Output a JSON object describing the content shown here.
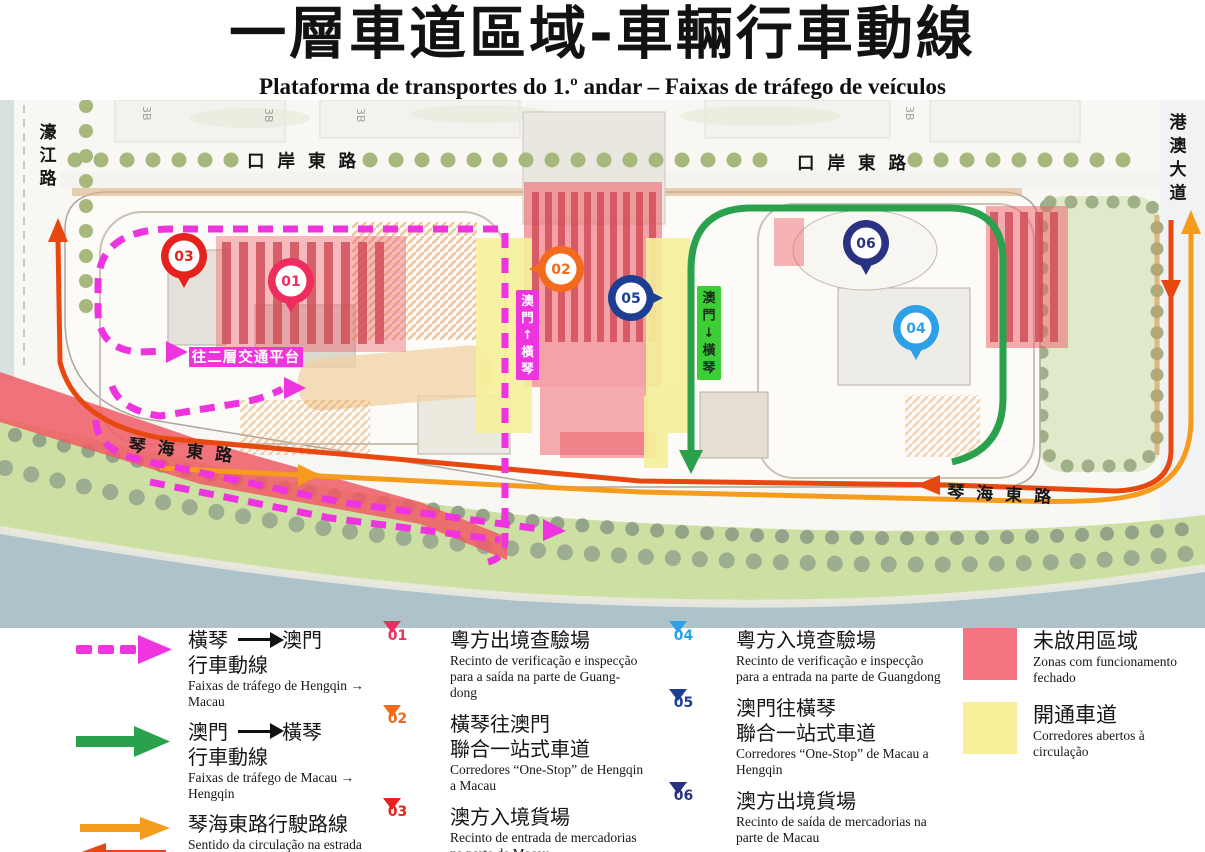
{
  "title": {
    "zh": "一層車道區域-車輛行車動線",
    "pt": "Plataforma de transportes do 1.º andar – Faixas de tráfego de veículos"
  },
  "colors": {
    "magenta": "#ee34df",
    "green": "#2aa14c",
    "green_label": "#3ccf35",
    "orange": "#f59b1e",
    "red_orange": "#e8470f",
    "red_zone": "#ee5a64",
    "red_strip": "#cf4a55",
    "yellow": "#f6ef9a",
    "water": "#adc3c9",
    "lawn": "#cde0a4",
    "park": "#e0e9c9"
  },
  "map": {
    "roads": {
      "haojiang": "濠江路",
      "kouan_east_1": "口岸東路",
      "kouan_east_2": "口岸東路",
      "gangao_avenue": "港澳大道",
      "qinhai_east_1": "琴海東路",
      "qinhai_east_2": "琴海東路"
    },
    "overlays": {
      "to_level2": "往二層交通平台",
      "corridor_magenta": "澳門↑橫琴",
      "corridor_green": "澳門↓橫琴",
      "block_label": "3B"
    },
    "markers": [
      {
        "label": "01",
        "color": "#ee2d5e"
      },
      {
        "label": "02",
        "color": "#f26a1b"
      },
      {
        "label": "03",
        "color": "#e3231c"
      },
      {
        "label": "04",
        "color": "#2ea0e8"
      },
      {
        "label": "05",
        "color": "#1c3f94"
      },
      {
        "label": "06",
        "color": "#283182"
      }
    ]
  },
  "legend": {
    "routes": [
      {
        "zh_from": "橫琴",
        "zh_to": "澳門",
        "zh_line2": "行車動線",
        "pt": "Faixas de tráfego de Hengqin →\nMacau"
      },
      {
        "zh_from": "澳門",
        "zh_to": "橫琴",
        "zh_line2": "行車動線",
        "pt": "Faixas de tráfego de Macau →\nHengqin"
      },
      {
        "zh_single": "琴海東路行駛路線",
        "pt": "Sentido da circulação na estrada\nQinhai East"
      }
    ],
    "points": [
      {
        "label": "01",
        "color": "#ee2d5e",
        "zh": "粵方出境查驗場",
        "pt": "Recinto de verificação e inspecção\npara a saída na parte de Guang-\ndong"
      },
      {
        "label": "02",
        "color": "#f26a1b",
        "zh": "橫琴往澳門\n聯合一站式車道",
        "pt": "Corredores “One-Stop” de Hengqin\na Macau"
      },
      {
        "label": "03",
        "color": "#e3231c",
        "zh": "澳方入境貨場",
        "pt": "Recinto de entrada de mercadorias\nna parte de Macau"
      },
      {
        "label": "04",
        "color": "#2ea0e8",
        "zh": "粵方入境查驗場",
        "pt": "Recinto de verificação e inspecção\npara a entrada na parte de Guangdong"
      },
      {
        "label": "05",
        "color": "#1c3f94",
        "zh": "澳門往橫琴\n聯合一站式車道",
        "pt": "Corredores “One-Stop” de Macau a\nHengqin"
      },
      {
        "label": "06",
        "color": "#283182",
        "zh": "澳方出境貨場",
        "pt": "Recinto de saída de mercadorias na\nparte de Macau"
      }
    ],
    "zones": [
      {
        "color": "#f4757f",
        "zh": "未啟用區域",
        "pt": "Zonas com funcionamento\nfechado"
      },
      {
        "color": "#f8ef9b",
        "zh": "開通車道",
        "pt": "Corredores abertos à\ncirculação"
      }
    ]
  }
}
